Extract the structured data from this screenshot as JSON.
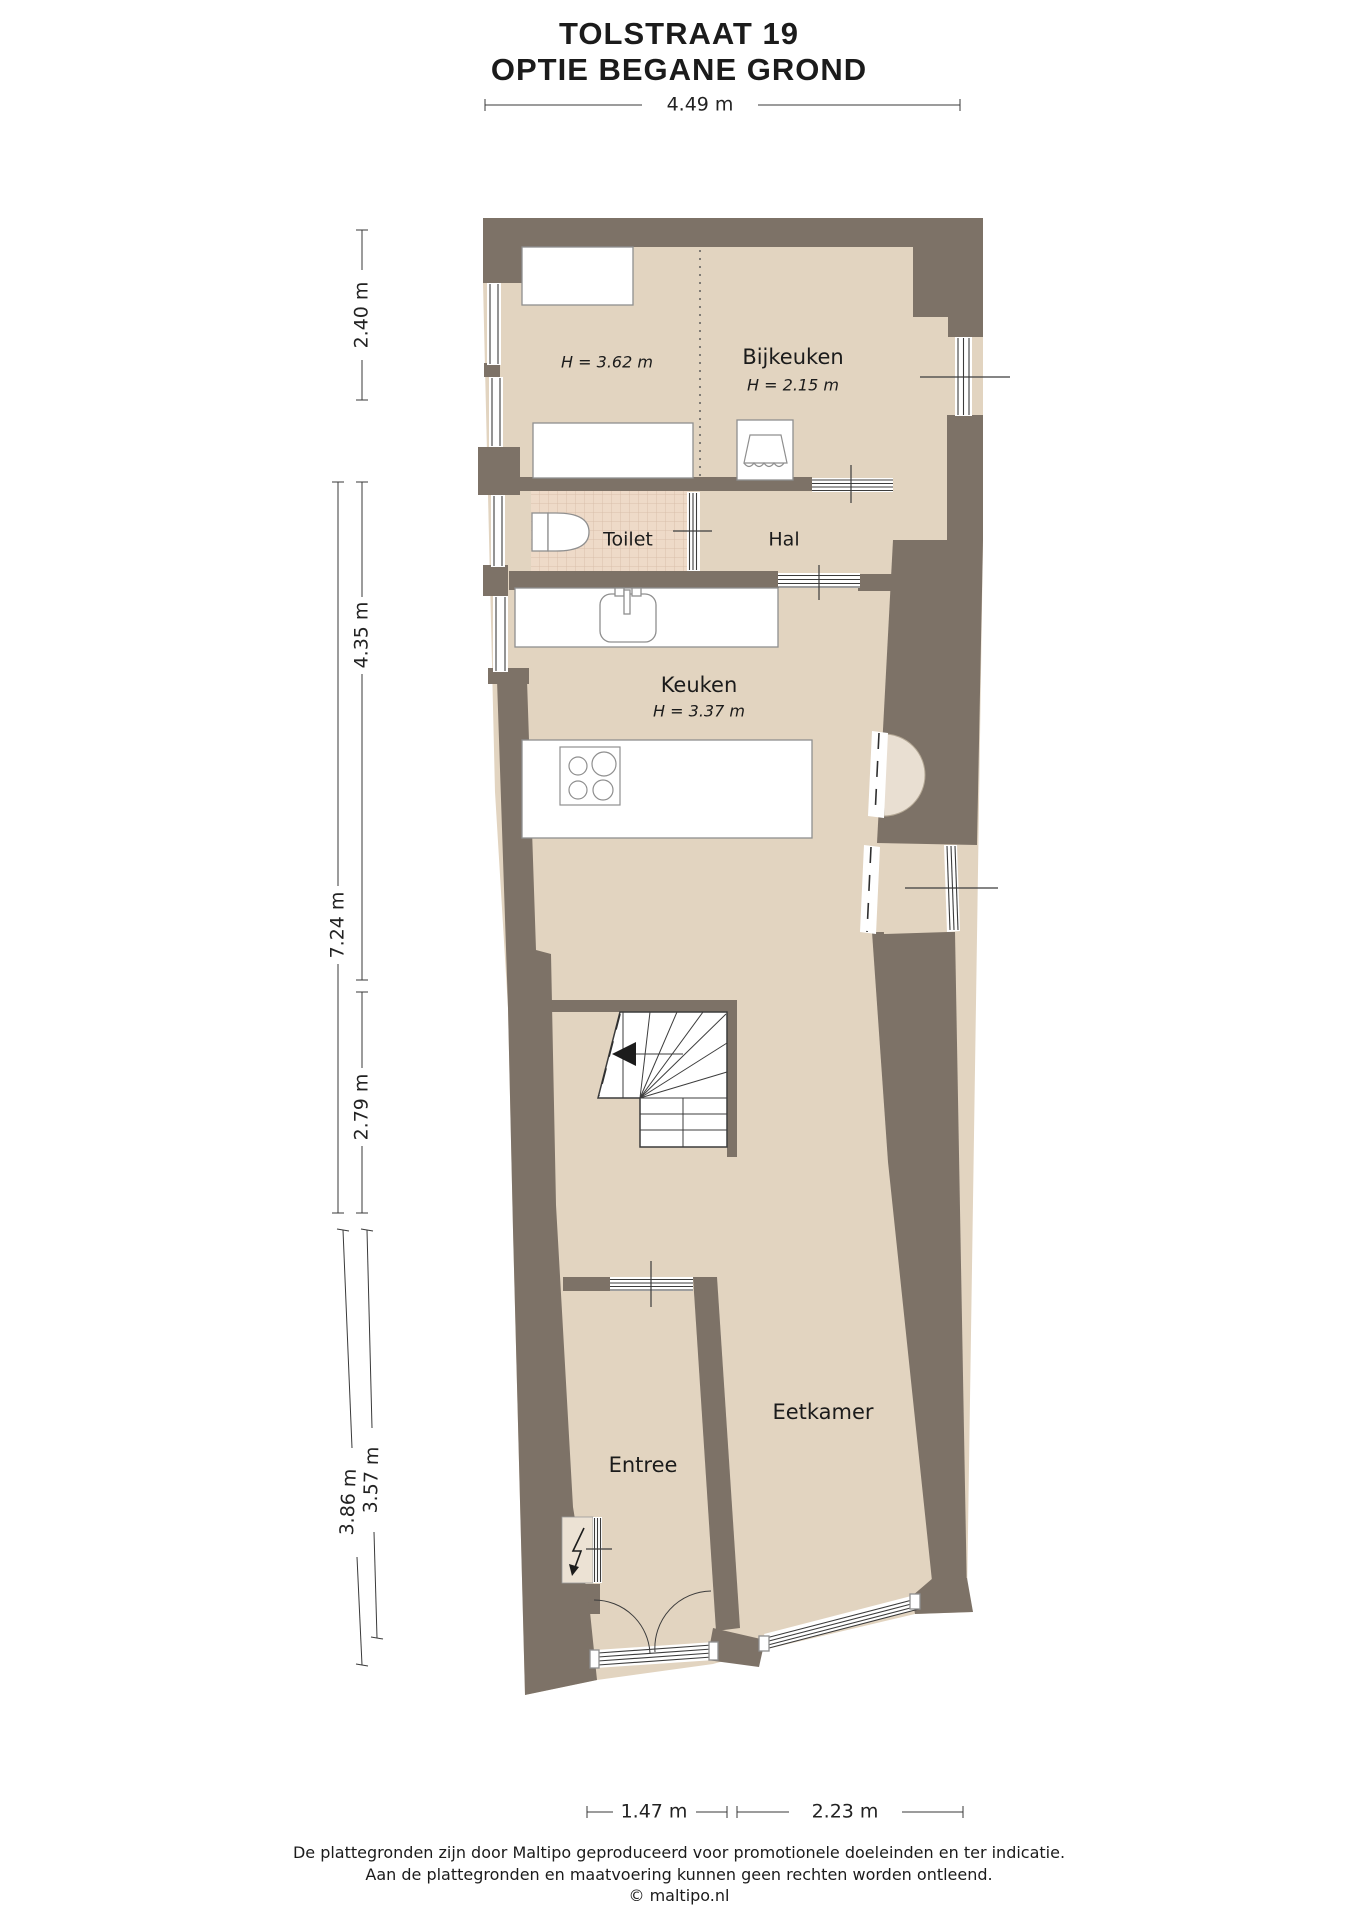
{
  "title": {
    "line1": "TOLSTRAAT 19",
    "line2": "OPTIE BEGANE GROND"
  },
  "rooms": {
    "bijkeuken": {
      "name": "Bijkeuken",
      "height": "H = 2.15 m"
    },
    "left_zone_height": "H = 3.62 m",
    "toilet": {
      "name": "Toilet"
    },
    "hal": {
      "name": "Hal"
    },
    "keuken": {
      "name": "Keuken",
      "height": "H = 3.37 m"
    },
    "entree": {
      "name": "Entree"
    },
    "eetkamer": {
      "name": "Eetkamer"
    }
  },
  "dimensions": {
    "top_width": "4.49 m",
    "left_bijkeuken": "2.40 m",
    "left_keuken": "4.35 m",
    "left_total": "7.24 m",
    "left_stairs": "2.79 m",
    "left_entree_outer": "3.86 m",
    "left_entree_inner": "3.57 m",
    "bottom_entree": "1.47 m",
    "bottom_eetkamer": "2.23 m"
  },
  "footer": {
    "line1": "De plattegronden zijn door Maltipo geproduceerd voor promotionele doeleinden en ter indicatie.",
    "line2": "Aan de plattegronden en maatvoering kunnen geen rechten worden ontleend.",
    "line3": "© maltipo.nl"
  },
  "icons": {
    "toilet-icon": "toilet bowl outline",
    "sink-icon": "kitchen sink with faucet",
    "stove-icon": "4-burner hob circles",
    "washing-machine-icon": "laundry basin glyph",
    "lightning-icon": "electric meter bolt arrow",
    "stairs-arrow-icon": "stair direction arrow",
    "door-swing-icon": "double entrance door arcs"
  },
  "colors": {
    "wall": "#7d7267",
    "floor": "#e2d4c0",
    "toilet_tile": "#eedac8",
    "tile_line": "#d9c0ab",
    "alcove": "#e9dfd2",
    "text": "#1b1b1b",
    "dimension_line": "#3a3a3a",
    "background": "#ffffff"
  }
}
